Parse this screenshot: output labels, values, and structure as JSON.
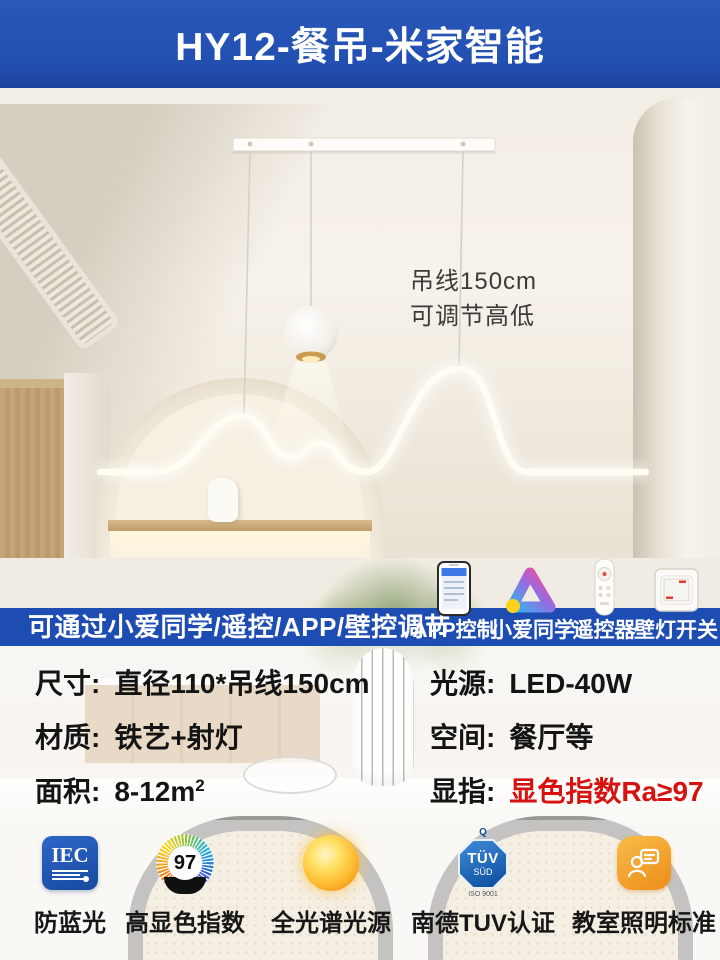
{
  "header": {
    "title": "HY12-餐吊-米家智能"
  },
  "photo": {
    "note_line1": "吊线150cm",
    "note_line2": "可调节高低"
  },
  "control_bar": {
    "headline": "可通过小爱同学/遥控/APP/壁控调节",
    "items": [
      {
        "label": "APP控制",
        "icon": "phone-app-icon"
      },
      {
        "label": "小爱同学",
        "icon": "xiaoai-logo-icon"
      },
      {
        "label": "遥控器",
        "icon": "remote-control-icon"
      },
      {
        "label": "壁灯开关",
        "icon": "wall-switch-icon"
      }
    ]
  },
  "specs": {
    "size_label": "尺寸:",
    "size_value": "直径110*吊线150cm",
    "light_label": "光源:",
    "light_value": "LED-40W",
    "material_label": "材质:",
    "material_value": "铁艺+射灯",
    "space_label": "空间:",
    "space_value": "餐厅等",
    "area_label": "面积:",
    "area_value": "8-12m",
    "area_sup": "2",
    "cri_label": "显指:",
    "cri_value": "显色指数Ra≥97"
  },
  "certs": {
    "iec": {
      "badge": "IEC",
      "label": "防蓝光"
    },
    "cri": {
      "badge": "97",
      "label": "高显色指数"
    },
    "spectrum": {
      "label": "全光谱光源"
    },
    "tuv": {
      "badge_q": "Q",
      "badge_line1": "TÜV",
      "badge_line2": "SÜD",
      "badge_sub": "ISO 9001",
      "label": "南德TUV认证"
    },
    "classroom": {
      "label": "教室照明标准"
    }
  },
  "colors": {
    "banner_blue": "#2250b2",
    "strip_blue": "#1d4cb3",
    "highlight_red": "#d5120f",
    "wood": "#c6a477",
    "warm_glow": "#fff6dd"
  }
}
